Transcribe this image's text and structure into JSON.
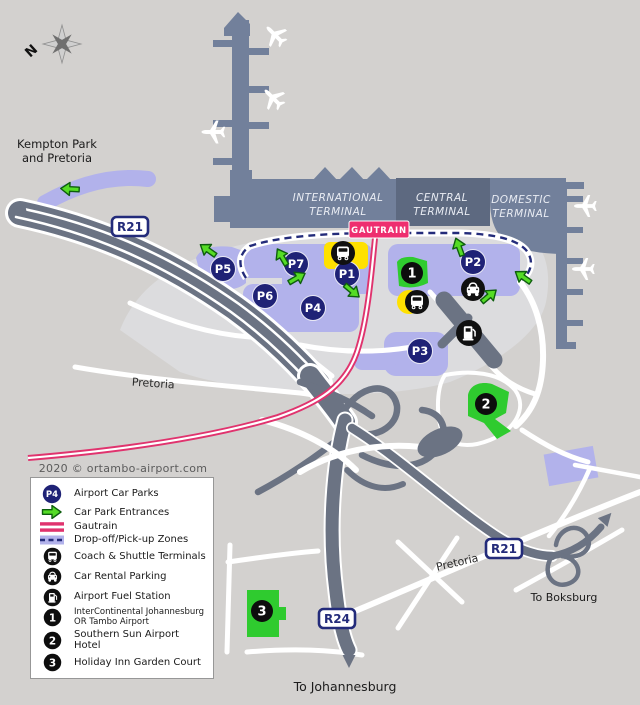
{
  "map": {
    "compass_label": "N",
    "copyright": "2020 © ortambo-airport.com",
    "labels": {
      "kempton_line1": "Kempton Park",
      "kempton_line2": "and Pretoria",
      "pretoria_upper": "Pretoria",
      "pretoria_lower": "Pretoria",
      "to_boksburg": "To Boksburg",
      "to_johannesburg": "To Johannesburg"
    },
    "terminals": [
      {
        "line1": "INTERNATIONAL",
        "line2": "TERMINAL"
      },
      {
        "line1": "CENTRAL",
        "line2": "TERMINAL"
      },
      {
        "line1": "DOMESTIC",
        "line2": "TERMINAL"
      }
    ],
    "gautrain_badge": "GAUTRAIN",
    "route_badges": [
      {
        "label": "R21"
      },
      {
        "label": "R21"
      },
      {
        "label": "R24"
      }
    ],
    "car_parks": [
      {
        "label": "P5"
      },
      {
        "label": "P7"
      },
      {
        "label": "P1"
      },
      {
        "label": "P6"
      },
      {
        "label": "P4"
      },
      {
        "label": "P2"
      },
      {
        "label": "P3"
      }
    ],
    "hotel_markers": [
      {
        "label": "1"
      },
      {
        "label": "2"
      },
      {
        "label": "3"
      }
    ]
  },
  "legend": {
    "badge_label": "P4",
    "items": [
      {
        "icon": "car-park-badge",
        "label": "Airport Car Parks"
      },
      {
        "icon": "entrance-arrow",
        "label": "Car Park Entrances"
      },
      {
        "icon": "gautrain-line",
        "label": "Gautrain"
      },
      {
        "icon": "dropoff-zone",
        "label": "Drop-off/Pick-up Zones"
      },
      {
        "icon": "coach-shuttle",
        "label": "Coach & Shuttle Terminals"
      },
      {
        "icon": "car-rental",
        "label": "Car Rental Parking"
      },
      {
        "icon": "fuel-station",
        "label": "Airport Fuel Station"
      },
      {
        "icon": "hotel-1",
        "label": "InterContinental Johannesburg OR Tambo Airport"
      },
      {
        "icon": "hotel-2",
        "label": "Southern Sun Airport Hotel"
      },
      {
        "icon": "hotel-3",
        "label": "Holiday Inn Garden Court"
      }
    ]
  },
  "colors": {
    "background": "#D3D1CF",
    "terminal": "#72809B",
    "terminal_central": "#5D6980",
    "car_park_area": "#B2B2EB",
    "navy": "#1F2276",
    "road": "#6B7383",
    "gautrain_pink": "#EE2E6F",
    "entrance_green": "#55DC26",
    "hotel_green": "#2FCB2F",
    "shuttle_yellow": "#FFE100"
  }
}
